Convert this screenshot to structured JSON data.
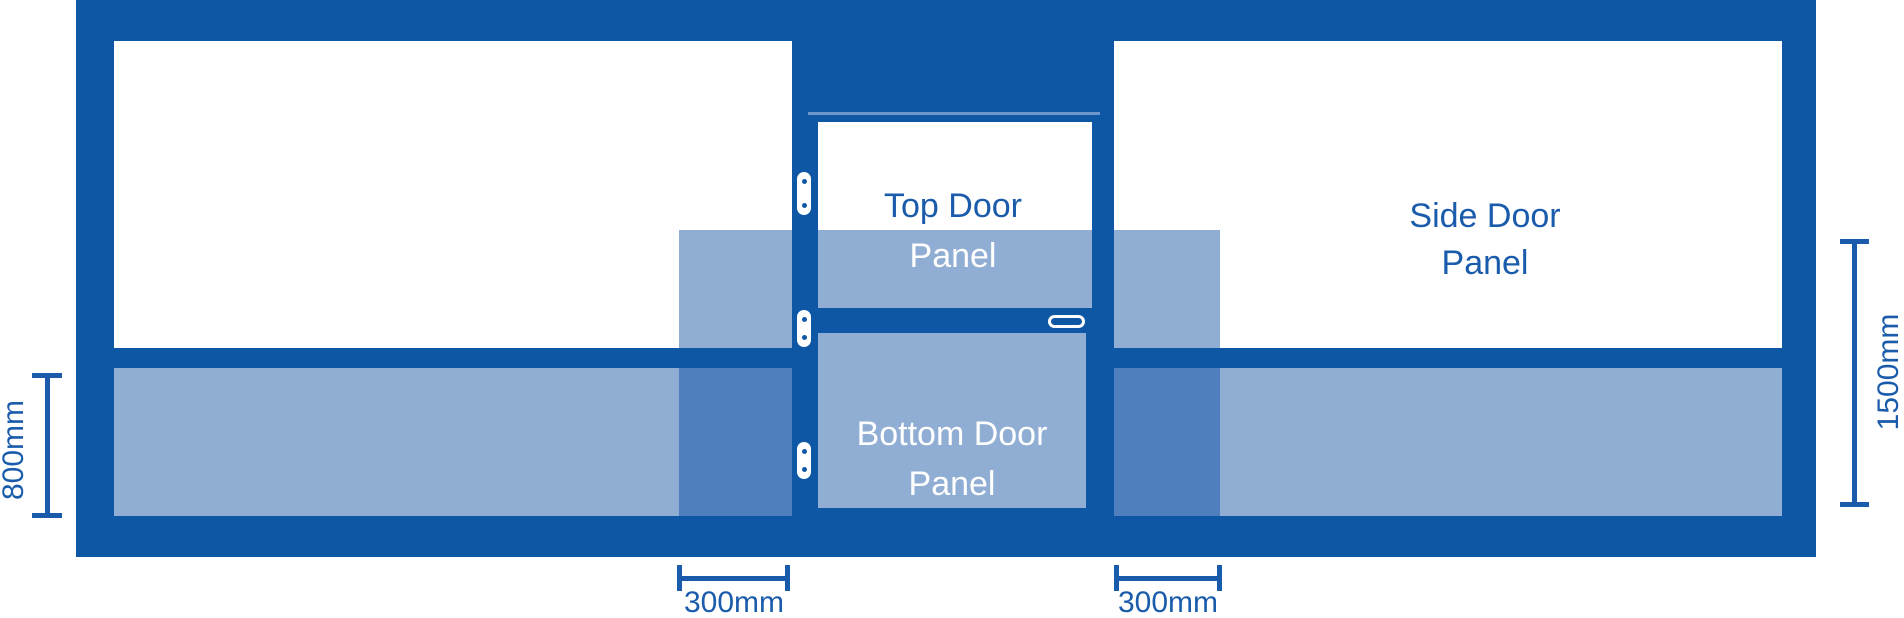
{
  "title": "Door panel dimension diagram",
  "colors": {
    "frame": "#0d57a5",
    "panel_tint": "#90aed4",
    "overlap_tint": "#4f80bd",
    "label_blue": "#1a5cab",
    "dim_blue": "#1a5cab",
    "seam": "#6d97cc"
  },
  "panels": {
    "top_door": {
      "line1": "Top Door",
      "line2": "Panel"
    },
    "bottom_door": {
      "line1": "Bottom Door",
      "line2": "Panel"
    },
    "side_door": {
      "line1": "Side Door",
      "line2": "Panel"
    }
  },
  "dimensions": {
    "left_height": "800mm",
    "right_height": "1500mm",
    "bottom_left_width": "300mm",
    "bottom_right_width": "300mm"
  },
  "icons": {
    "hinge": "door-hinge",
    "handle": "door-handle"
  }
}
